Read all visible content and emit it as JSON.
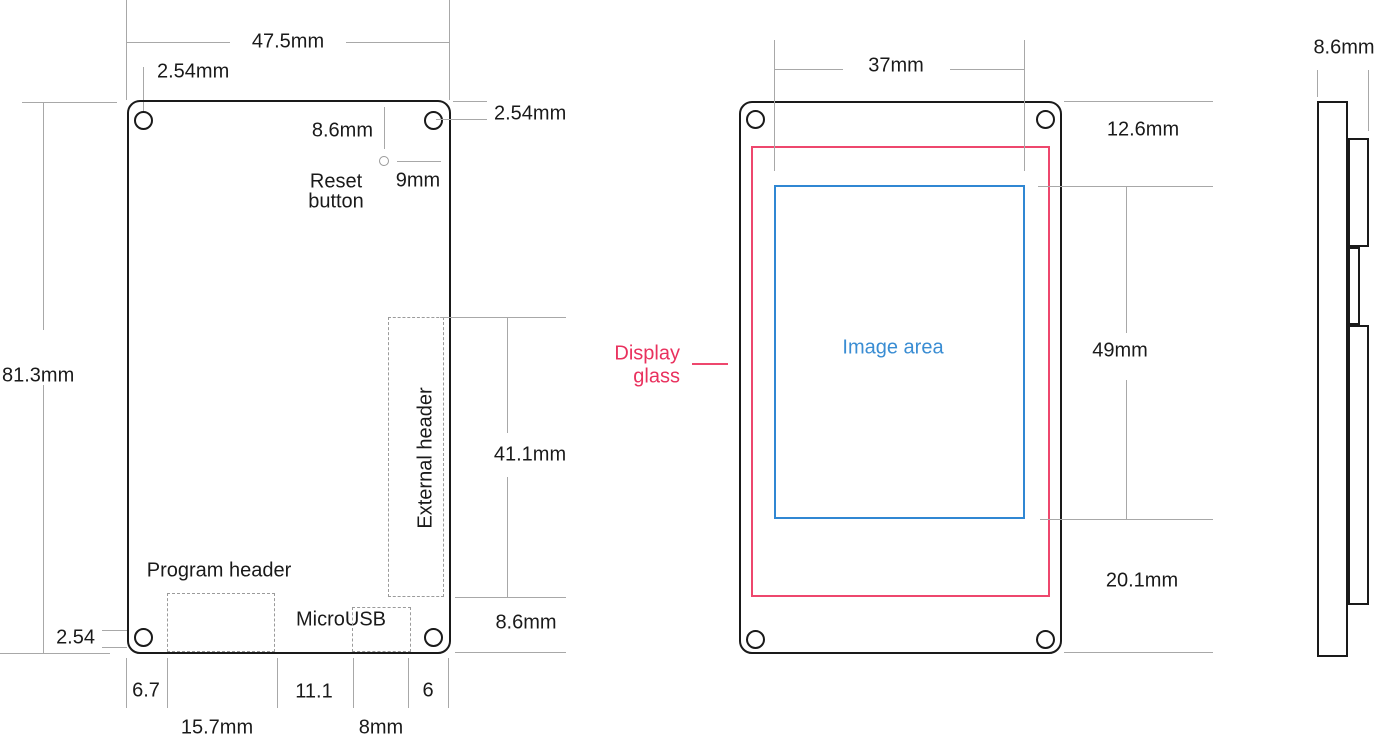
{
  "figure": {
    "type": "mechanical-drawing",
    "views": [
      "back",
      "front",
      "side"
    ]
  },
  "colors": {
    "ink": "#1a1a1a",
    "dimension_line": "#a8a8a8",
    "dashed_outline": "#9b9b9b",
    "display_glass": "#ee476d",
    "display_glass_text": "#e9315e",
    "image_area": "#3087d3"
  },
  "back_view": {
    "board_width": "47.5mm",
    "hole_offset_top": "2.54mm",
    "hole_offset_right": "2.54mm",
    "board_height": "81.3mm",
    "reset_offset_v": "8.6mm",
    "reset_offset_h": "9mm",
    "reset_label_1": "Reset",
    "reset_label_2": "button",
    "external_header_label": "External header",
    "external_header_length": "41.1mm",
    "external_header_bottom_offset": "8.6mm",
    "program_header_label": "Program header",
    "microusb_label": "MicroUSB",
    "hole_offset_bottom": "2.54",
    "bottom_dims": {
      "edge_to_program": "6.7",
      "program_width": "15.7mm",
      "program_to_usb": "11.1",
      "usb_width": "8mm",
      "usb_to_edge": "6"
    }
  },
  "front_view": {
    "image_width": "37mm",
    "top_margin": "12.6mm",
    "image_height": "49mm",
    "bottom_margin": "20.1mm",
    "display_glass_label_1": "Display",
    "display_glass_label_2": "glass",
    "image_area_label": "Image area"
  },
  "side_view": {
    "thickness": "8.6mm"
  }
}
